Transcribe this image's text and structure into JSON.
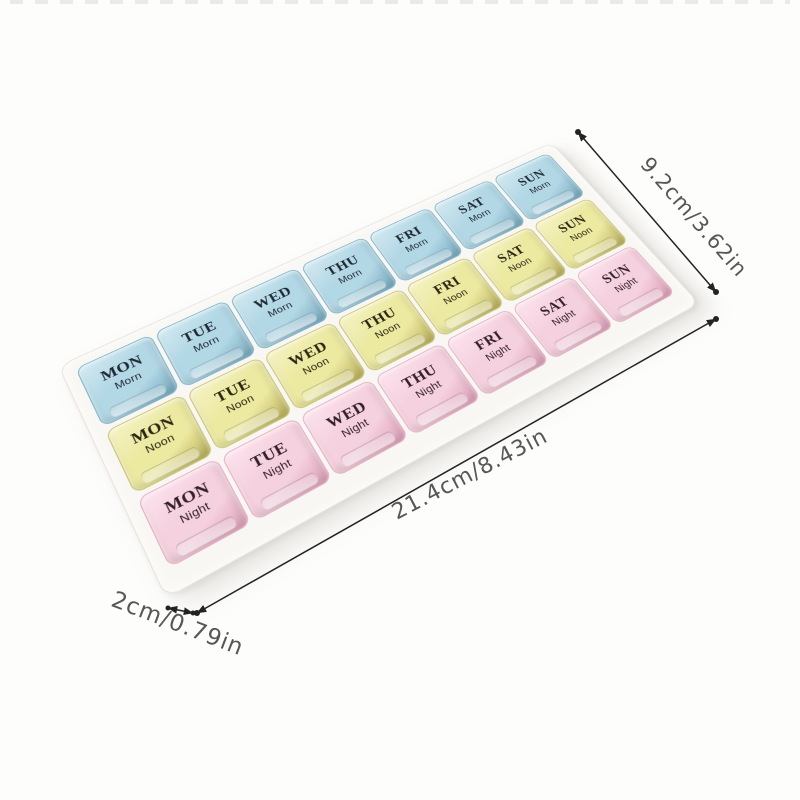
{
  "pill_organizer": {
    "days": [
      "MON",
      "TUE",
      "WED",
      "THU",
      "FRI",
      "SAT",
      "SUN"
    ],
    "rows": [
      {
        "period": "Morn",
        "lid_color": "#b2d7e5",
        "lid_light": "#d4eaf1",
        "lid_edge": "#83b7cc",
        "lid_deep": "#74a8be",
        "label_color": "#1f2933"
      },
      {
        "period": "Noon",
        "lid_color": "#ece9a1",
        "lid_light": "#f5f3c4",
        "lid_edge": "#cdc676",
        "lid_deep": "#b9af58",
        "label_color": "#2a2613"
      },
      {
        "period": "Night",
        "lid_color": "#f5d0de",
        "lid_light": "#fce4ee",
        "lid_edge": "#eab1c7",
        "lid_deep": "#dd9fb8",
        "label_color": "#33202b"
      }
    ],
    "tray_color": "#f9f7f3",
    "tray_edge_color": "#e9e5df"
  },
  "dimension_annotations": {
    "height": {
      "label": "9.2cm/3.62in"
    },
    "length": {
      "label": "21.4cm/8.43in"
    },
    "depth": {
      "label": "2cm/0.79in"
    },
    "line_color": "#232323",
    "text_color": "#575757"
  }
}
